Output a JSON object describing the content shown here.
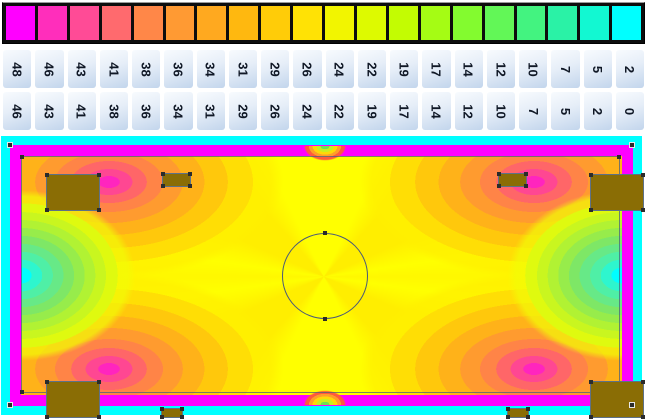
{
  "chart_data": {
    "type": "heatmap",
    "title": "",
    "legend_position": "top",
    "colorbar": {
      "colors": [
        "#FF00FF",
        "#FF2EBB",
        "#FF4B96",
        "#FF6A6E",
        "#FF8748",
        "#FF9A33",
        "#FFA91F",
        "#FFB80F",
        "#FFCC08",
        "#FFE205",
        "#F2F500",
        "#DDFA00",
        "#C3FC02",
        "#A5FC14",
        "#83FB2F",
        "#62F757",
        "#43F380",
        "#2AF2A6",
        "#12F8D2",
        "#00FFFF"
      ],
      "range_upper": [
        "48",
        "46",
        "43",
        "41",
        "38",
        "36",
        "34",
        "31",
        "29",
        "26",
        "24",
        "22",
        "19",
        "17",
        "14",
        "12",
        "10",
        "7",
        "5",
        "2"
      ],
      "range_lower": [
        "46",
        "43",
        "41",
        "38",
        "36",
        "34",
        "31",
        "29",
        "26",
        "24",
        "22",
        "19",
        "17",
        "14",
        "12",
        "10",
        "7",
        "5",
        "2",
        "0"
      ]
    },
    "map": {
      "frame_color": "#00FFFF",
      "border_band_color": "#FF00FF",
      "field_base_color": "#FFFF00",
      "furniture_color": "#8A6D05",
      "regions": [
        {
          "area": "perimeter wall band",
          "value_range": "46-48"
        },
        {
          "area": "main floor field",
          "value_range": "22-29"
        },
        {
          "area": "corner hotspots beside cabinets",
          "value_range": "31-46"
        },
        {
          "area": "left and right wall mid-points",
          "value_range": "0-7"
        },
        {
          "area": "outer frame",
          "value_range": "0-2"
        },
        {
          "area": "top and bottom centre door spots",
          "value_range": "5-38"
        }
      ]
    }
  }
}
